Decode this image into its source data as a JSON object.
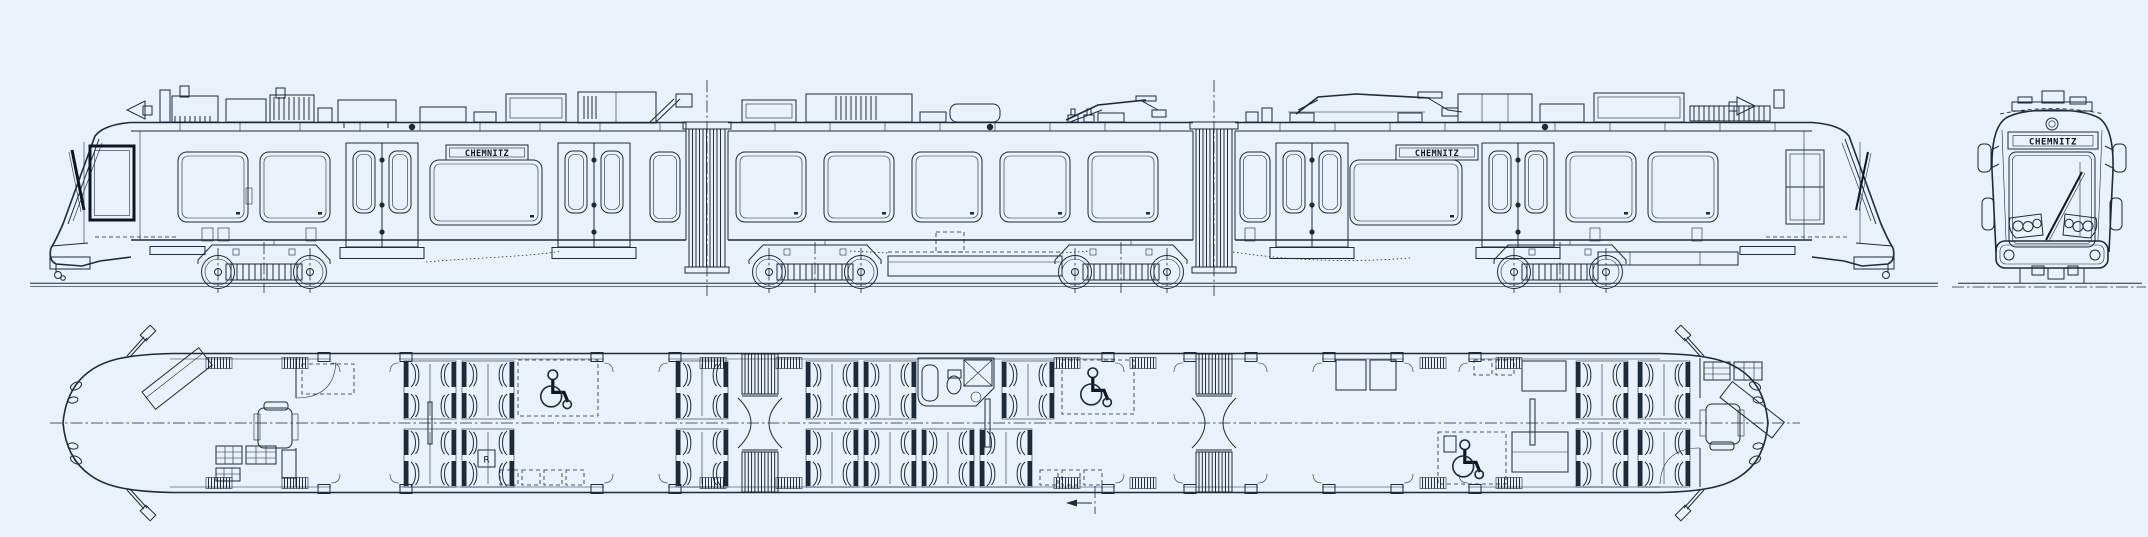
{
  "page": {
    "background_color": "#e9f1fb",
    "line_color": "#1d2a38",
    "strong_line_color": "#0d1622"
  },
  "views": {
    "side_elevation": {
      "destination_sign_car_a": "CHEMNITZ",
      "destination_sign_car_c": "CHEMNITZ"
    },
    "front_view": {
      "destination_sign": "CHEMNITZ"
    },
    "floor_plan": {
      "compartment_label": "R"
    }
  },
  "icons": {
    "wheelchair_icon": "wheelchair space marker",
    "pantograph_icon": "roof pantograph",
    "mirror_icon": "exterior rear-view mirror",
    "coupler_icon": "front coupler",
    "toilet_icon": "toilet module",
    "direction_arrow_icon": "travel direction arrow"
  }
}
